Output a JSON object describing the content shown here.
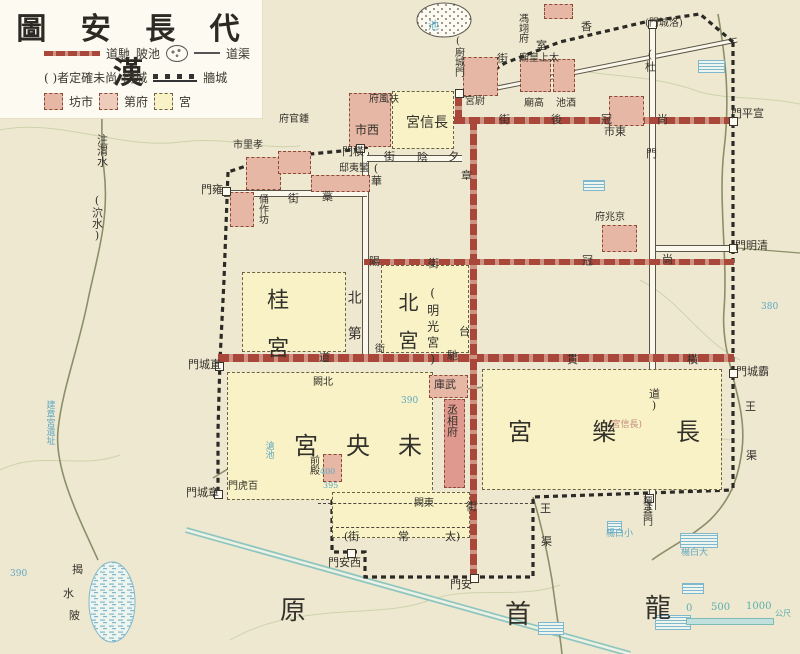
{
  "title": "圖 安 長 代 漢",
  "colors": {
    "background": "#efe8d0",
    "road_red": "#a8473a",
    "palace_yellow": "#f8f2c6",
    "site_pink": "#e7b7a6",
    "wall_ink": "#2c2a26",
    "modern_blue": "#5fa8c2",
    "modern_teal": "#8fc6c0",
    "label_ink": "#33312b"
  },
  "legend": {
    "rows": [
      [
        {
          "icon": "chidao-road-line"
        },
        {
          "text": "道馳"
        },
        {
          "text": "陂池"
        },
        {
          "icon": "pond-symbol"
        },
        {
          "icon": "canal-line"
        },
        {
          "text": "道渠"
        }
      ],
      [
        {
          "text": "( )者定確未尚"
        },
        {
          "text": "門城"
        },
        {
          "icon": "wall-symbol"
        },
        {
          "text": "牆城"
        }
      ],
      [
        {
          "icon": "market-box"
        },
        {
          "text": "坊市"
        },
        {
          "icon": "mansion-box"
        },
        {
          "text": "第府"
        },
        {
          "icon": "palace-box"
        },
        {
          "text": "宮"
        }
      ]
    ]
  },
  "scalebar": {
    "ticks": [
      "0",
      "500",
      "1000"
    ],
    "unit": "公尺"
  },
  "map": {
    "boxes": [
      {
        "n": "palace-gui",
        "kind": "palace",
        "x": 242,
        "y": 272,
        "w": 104,
        "h": 80
      },
      {
        "n": "palace-bei",
        "kind": "palace",
        "x": 381,
        "y": 265,
        "w": 88,
        "h": 88
      },
      {
        "n": "palace-changxin-north",
        "kind": "palace",
        "x": 392,
        "y": 91,
        "w": 62,
        "h": 58
      },
      {
        "n": "palace-weiyang",
        "kind": "palace",
        "x": 227,
        "y": 372,
        "w": 206,
        "h": 128
      },
      {
        "n": "palace-changle",
        "kind": "palace",
        "x": 482,
        "y": 369,
        "w": 240,
        "h": 121
      },
      {
        "n": "south-annex-block",
        "kind": "palace",
        "x": 332,
        "y": 492,
        "w": 138,
        "h": 46
      },
      {
        "n": "west-market-box",
        "kind": "site",
        "x": 349,
        "y": 93,
        "w": 42,
        "h": 54
      },
      {
        "n": "east-market-box",
        "kind": "site",
        "x": 609,
        "y": 96,
        "w": 35,
        "h": 30
      },
      {
        "n": "xiaoli-market-box",
        "kind": "site",
        "x": 246,
        "y": 157,
        "w": 35,
        "h": 33
      },
      {
        "n": "zhongguanfu-box",
        "kind": "site",
        "x": 278,
        "y": 151,
        "w": 33,
        "h": 23
      },
      {
        "n": "yongzuofang-box",
        "kind": "site",
        "x": 230,
        "y": 192,
        "w": 24,
        "h": 35
      },
      {
        "n": "manyidi-box",
        "kind": "site",
        "x": 311,
        "y": 175,
        "w": 59,
        "h": 17
      },
      {
        "n": "weigong-box",
        "kind": "site",
        "x": 463,
        "y": 57,
        "w": 35,
        "h": 39
      },
      {
        "n": "gaomiao-box",
        "kind": "site",
        "x": 520,
        "y": 59,
        "w": 31,
        "h": 33
      },
      {
        "n": "taishanghuangmiao-box",
        "kind": "site",
        "x": 553,
        "y": 59,
        "w": 22,
        "h": 33
      },
      {
        "n": "fengyifu-box",
        "kind": "site",
        "x": 544,
        "y": 4,
        "w": 29,
        "h": 15
      },
      {
        "n": "jingzhaofu-box",
        "kind": "site",
        "x": 602,
        "y": 225,
        "w": 35,
        "h": 27
      },
      {
        "n": "wuku-box",
        "kind": "site",
        "x": 429,
        "y": 375,
        "w": 39,
        "h": 23
      },
      {
        "n": "chengxiangfu-box",
        "kind": "site-solid",
        "x": 444,
        "y": 399,
        "w": 21,
        "h": 89
      },
      {
        "n": "qiandian-box",
        "kind": "site",
        "x": 323,
        "y": 454,
        "w": 19,
        "h": 28
      }
    ],
    "labels": [
      {
        "n": "gate-hengmen",
        "t": "門橫",
        "x": 342,
        "y": 146,
        "s": 11
      },
      {
        "n": "gate-chucheng",
        "t": "(廚城門",
        "x": 452,
        "y": 36,
        "s": 10,
        "v": true
      },
      {
        "n": "gate-luocheng",
        "t": "(門城洛)",
        "x": 645,
        "y": 19,
        "s": 10
      },
      {
        "n": "gate-xuanping",
        "t": "門平宣",
        "x": 731,
        "y": 108,
        "s": 11
      },
      {
        "n": "gate-qingming",
        "t": "門明清",
        "x": 735,
        "y": 240,
        "s": 11
      },
      {
        "n": "gate-bacheng",
        "t": "門城霸",
        "x": 736,
        "y": 366,
        "s": 11
      },
      {
        "n": "gate-yongmen",
        "t": "門雍",
        "x": 201,
        "y": 184,
        "s": 11
      },
      {
        "n": "gate-zhicheng",
        "t": "門城直",
        "x": 188,
        "y": 359,
        "s": 11
      },
      {
        "n": "gate-zhangcheng",
        "t": "門城章",
        "x": 186,
        "y": 487,
        "s": 11
      },
      {
        "n": "gate-xian",
        "t": "門安西",
        "x": 328,
        "y": 557,
        "s": 11
      },
      {
        "n": "gate-anmen",
        "t": "門安",
        "x": 450,
        "y": 579,
        "s": 11
      },
      {
        "n": "gate-fuang",
        "t": "覆盎門",
        "x": 640,
        "y": 496,
        "s": 10,
        "v": true
      },
      {
        "n": "gate-baihu",
        "t": "門虎百",
        "x": 228,
        "y": 482,
        "s": 10
      },
      {
        "n": "gate-du-1",
        "t": "(杜",
        "x": 644,
        "y": 48,
        "s": 11,
        "v": true
      },
      {
        "n": "gate-du-2",
        "t": "門",
        "x": 646,
        "y": 148,
        "s": 11
      },
      {
        "n": "office-fengyifu",
        "t": "馮翊府",
        "x": 516,
        "y": 13,
        "s": 10,
        "v": true
      },
      {
        "n": "office-fufengfu",
        "t": "府風扶",
        "x": 369,
        "y": 95,
        "s": 10
      },
      {
        "n": "office-zhongguanfu",
        "t": "府官鍾",
        "x": 279,
        "y": 115,
        "s": 10
      },
      {
        "n": "market-xiaoli",
        "t": "市里孝",
        "x": 233,
        "y": 141,
        "s": 10
      },
      {
        "n": "site-yongzuofang",
        "t": "俑作坊",
        "x": 256,
        "y": 194,
        "s": 10,
        "v": true
      },
      {
        "n": "site-manyidi",
        "t": "邸夷蠻",
        "x": 339,
        "y": 164,
        "s": 10
      },
      {
        "n": "market-west",
        "t": "市西",
        "x": 355,
        "y": 124,
        "s": 12
      },
      {
        "n": "palace-changxin-label",
        "t": "宮信長",
        "x": 406,
        "y": 116,
        "s": 14
      },
      {
        "n": "site-weigong",
        "t": "宮尉",
        "x": 465,
        "y": 97,
        "s": 10
      },
      {
        "n": "site-taishanghuangmiao",
        "t": "廟皇上太",
        "x": 519,
        "y": 54,
        "s": 10
      },
      {
        "n": "site-gaomiao",
        "t": "廟高",
        "x": 524,
        "y": 99,
        "s": 10
      },
      {
        "n": "site-jiuchi",
        "t": "池酒",
        "x": 556,
        "y": 99,
        "s": 10
      },
      {
        "n": "market-east",
        "t": "市東",
        "x": 604,
        "y": 126,
        "s": 11
      },
      {
        "n": "office-jingzhaofu",
        "t": "府兆京",
        "x": 595,
        "y": 213,
        "s": 10
      },
      {
        "n": "site-wuku",
        "t": "庫武",
        "x": 434,
        "y": 379,
        "s": 11
      },
      {
        "n": "office-chengxiangfu",
        "t": "丞相府",
        "x": 446,
        "y": 404,
        "s": 11,
        "v": true
      },
      {
        "n": "site-qiandian",
        "t": "前殿",
        "x": 307,
        "y": 455,
        "s": 10,
        "v": true
      },
      {
        "n": "site-beique",
        "t": "闕北",
        "x": 313,
        "y": 378,
        "s": 10
      },
      {
        "n": "site-dongque",
        "t": "闕東",
        "x": 414,
        "y": 499,
        "s": 10
      },
      {
        "n": "palace-changxin-inner",
        "t": "(宮信長)",
        "x": 608,
        "y": 421,
        "s": 9,
        "c": "pinktext"
      },
      {
        "n": "palace-gui-label",
        "t": "桂宮",
        "x": 264,
        "y": 288,
        "s": 22,
        "v": true,
        "ls": 26
      },
      {
        "n": "palace-bei-label",
        "t": "北宮",
        "x": 396,
        "y": 292,
        "s": 20,
        "v": true,
        "ls": 18
      },
      {
        "n": "palace-mingguang-label",
        "t": "(明光宮)",
        "x": 426,
        "y": 286,
        "s": 12,
        "v": true,
        "ls": 4
      },
      {
        "n": "area-beidi-label",
        "t": "北第",
        "x": 346,
        "y": 290,
        "s": 14,
        "v": true,
        "ls": 22
      },
      {
        "n": "palace-weiyang-label",
        "t": "宮央未",
        "x": 294,
        "y": 434,
        "s": 24,
        "ls": 28
      },
      {
        "n": "palace-changle-label",
        "t": "宮樂長",
        "x": 508,
        "y": 420,
        "s": 24,
        "ls": 60
      },
      {
        "n": "street-shangguanhou-1",
        "t": "街",
        "x": 499,
        "y": 114,
        "s": 11
      },
      {
        "n": "street-shangguanhou-2",
        "t": "後",
        "x": 551,
        "y": 114,
        "s": 11
      },
      {
        "n": "street-shangguanhou-3",
        "t": "冠",
        "x": 601,
        "y": 114,
        "s": 11
      },
      {
        "n": "street-shangguanhou-4",
        "t": "尚",
        "x": 657,
        "y": 114,
        "s": 11
      },
      {
        "n": "street-xiangshi-1",
        "t": "香",
        "x": 581,
        "y": 21,
        "s": 11
      },
      {
        "n": "street-xiangshi-2",
        "t": "室",
        "x": 536,
        "y": 40,
        "s": 11
      },
      {
        "n": "street-xiangshi-3",
        "t": "街",
        "x": 497,
        "y": 53,
        "s": 11
      },
      {
        "n": "street-xiyin-1",
        "t": "街",
        "x": 384,
        "y": 151,
        "s": 11
      },
      {
        "n": "street-xiyin-2",
        "t": "陰",
        "x": 417,
        "y": 152,
        "s": 11
      },
      {
        "n": "street-xiyin-3",
        "t": "夕",
        "x": 448,
        "y": 151,
        "s": 11
      },
      {
        "n": "street-hua",
        "t": "(華",
        "x": 370,
        "y": 162,
        "s": 11,
        "v": true
      },
      {
        "n": "street-yang-1",
        "t": "陽",
        "x": 369,
        "y": 256,
        "s": 11
      },
      {
        "n": "street-yang-2",
        "t": "街",
        "x": 428,
        "y": 258,
        "s": 11
      },
      {
        "n": "street-shangguan-1",
        "t": "冠",
        "x": 582,
        "y": 255,
        "s": 11
      },
      {
        "n": "street-shangguan-2",
        "t": "尚",
        "x": 662,
        "y": 254,
        "s": 11
      },
      {
        "n": "street-zhangtai-1",
        "t": "章",
        "x": 461,
        "y": 170,
        "s": 11
      },
      {
        "n": "street-zhangtai-2",
        "t": "台",
        "x": 459,
        "y": 326,
        "s": 11
      },
      {
        "n": "street-v-jie",
        "t": "街",
        "x": 375,
        "y": 345,
        "s": 10
      },
      {
        "n": "street-chidao-1",
        "t": "道",
        "x": 319,
        "y": 352,
        "s": 11
      },
      {
        "n": "street-chidao-2",
        "t": "馳",
        "x": 447,
        "y": 350,
        "s": 11
      },
      {
        "n": "street-chidao-3",
        "t": "貫",
        "x": 567,
        "y": 354,
        "s": 11
      },
      {
        "n": "street-chidao-4",
        "t": "橫",
        "x": 687,
        "y": 354,
        "s": 11
      },
      {
        "n": "street-gao-1",
        "t": "街",
        "x": 288,
        "y": 193,
        "s": 11
      },
      {
        "n": "street-gao-2",
        "t": "藁",
        "x": 322,
        "y": 191,
        "s": 11
      },
      {
        "n": "street-taichang-1",
        "t": "(街",
        "x": 344,
        "y": 531,
        "s": 11
      },
      {
        "n": "street-taichang-2",
        "t": "常",
        "x": 398,
        "y": 531,
        "s": 11
      },
      {
        "n": "street-taichang-3",
        "t": "太)",
        "x": 445,
        "y": 531,
        "s": 11
      },
      {
        "n": "street-anmen-jie",
        "t": "街",
        "x": 466,
        "y": 501,
        "s": 11
      },
      {
        "n": "street-dao",
        "t": "道)",
        "x": 648,
        "y": 388,
        "s": 11,
        "v": true
      },
      {
        "n": "river-zhuweishui",
        "t": "注渭水",
        "x": 96,
        "y": 134,
        "s": 11,
        "v": true
      },
      {
        "n": "river-xueshui",
        "t": "(泬水)",
        "x": 91,
        "y": 194,
        "s": 11,
        "v": true
      },
      {
        "n": "pond-jieshuibei-1",
        "t": "揭",
        "x": 72,
        "y": 564,
        "s": 11
      },
      {
        "n": "pond-jieshuibei-2",
        "t": "水",
        "x": 63,
        "y": 588,
        "s": 11
      },
      {
        "n": "pond-jieshuibei-3",
        "t": "陂",
        "x": 69,
        "y": 610,
        "s": 11
      },
      {
        "n": "canal-wangqu-s1",
        "t": "王",
        "x": 540,
        "y": 503,
        "s": 11
      },
      {
        "n": "canal-wangqu-s2",
        "t": "渠",
        "x": 541,
        "y": 536,
        "s": 11
      },
      {
        "n": "canal-wangqu-e1",
        "t": "王",
        "x": 745,
        "y": 401,
        "s": 11
      },
      {
        "n": "canal-wangqu-e2",
        "t": "渠",
        "x": 746,
        "y": 450,
        "s": 11
      },
      {
        "n": "plateau-longshou-1",
        "t": "原",
        "x": 280,
        "y": 598,
        "s": 26
      },
      {
        "n": "plateau-longshou-2",
        "t": "首",
        "x": 505,
        "y": 602,
        "s": 26
      },
      {
        "n": "plateau-longshou-3",
        "t": "龍",
        "x": 645,
        "y": 596,
        "s": 26
      },
      {
        "n": "pond-chi-label",
        "t": "池",
        "x": 428,
        "y": 20,
        "s": 11,
        "c": "blue"
      },
      {
        "n": "pond-cangchi-label",
        "t": "滄池",
        "x": 263,
        "y": 441,
        "s": 9,
        "v": true,
        "c": "blue"
      },
      {
        "n": "village-xiaobaiyang",
        "t": "楊白小",
        "x": 606,
        "y": 530,
        "s": 9,
        "c": "blue"
      },
      {
        "n": "village-dabaiyang",
        "t": "楊白大",
        "x": 681,
        "y": 549,
        "s": 9,
        "c": "blue"
      },
      {
        "n": "ruin-jianzhanggong",
        "t": "建章宮遺址",
        "x": 44,
        "y": 400,
        "s": 9,
        "v": true,
        "c": "blue"
      },
      {
        "n": "contour-390-a",
        "t": "390",
        "x": 401,
        "y": 397,
        "s": 9,
        "c": "blue"
      },
      {
        "n": "contour-395",
        "t": "395",
        "x": 323,
        "y": 482,
        "s": 8,
        "c": "blue"
      },
      {
        "n": "contour-400",
        "t": "400",
        "x": 320,
        "y": 468,
        "s": 8,
        "c": "blue"
      },
      {
        "n": "contour-380",
        "t": "380",
        "x": 761,
        "y": 303,
        "s": 9,
        "c": "blue"
      },
      {
        "n": "contour-390-b",
        "t": "390",
        "x": 10,
        "y": 570,
        "s": 9,
        "c": "blue"
      },
      {
        "n": "scale-tick-0",
        "t": "0",
        "x": 686,
        "y": 604,
        "s": 10,
        "c": "teal"
      },
      {
        "n": "scale-tick-500",
        "t": "500",
        "x": 711,
        "y": 603,
        "s": 10,
        "c": "teal"
      },
      {
        "n": "scale-tick-1000",
        "t": "1000",
        "x": 746,
        "y": 602,
        "s": 10,
        "c": "teal"
      },
      {
        "n": "scale-unit",
        "t": "公尺",
        "x": 775,
        "y": 610,
        "s": 8,
        "c": "teal"
      }
    ],
    "villages_hatched": [
      {
        "n": "village-mark-1",
        "x": 698,
        "y": 60,
        "w": 27,
        "h": 13
      },
      {
        "n": "village-mark-2",
        "x": 607,
        "y": 521,
        "w": 15,
        "h": 12
      },
      {
        "n": "village-mark-3",
        "x": 680,
        "y": 533,
        "w": 38,
        "h": 15
      },
      {
        "n": "village-mark-4",
        "x": 655,
        "y": 615,
        "w": 36,
        "h": 15
      },
      {
        "n": "village-mark-5",
        "x": 538,
        "y": 622,
        "w": 26,
        "h": 13
      },
      {
        "n": "village-mark-6",
        "x": 88,
        "y": 38,
        "w": 28,
        "h": 12
      },
      {
        "n": "village-mark-7",
        "x": 583,
        "y": 180,
        "w": 22,
        "h": 11
      },
      {
        "n": "village-mark-8",
        "x": 682,
        "y": 583,
        "w": 22,
        "h": 11
      }
    ]
  }
}
